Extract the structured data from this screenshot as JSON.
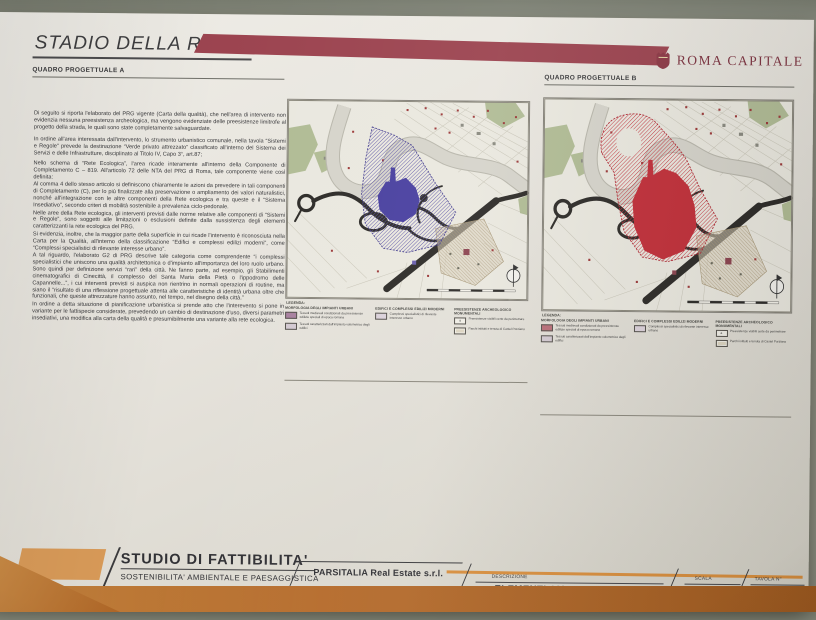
{
  "page": {
    "wall_color": "#8d9184",
    "table_color": "#b56b2b",
    "paper_color": "#e7e4dd",
    "accent_band_red": "#9c4450",
    "accent_orange": "#d89a58",
    "overlay_purple": "#4a41a0",
    "overlay_red": "#c2303a"
  },
  "header": {
    "title": "STADIO DELLA ROMA",
    "brand": "ROMA CAPITALE",
    "panel_a_label": "QUADRO PROGETTUALE A",
    "panel_b_label": "QUADRO PROGETTUALE B"
  },
  "intro": {
    "paragraphs": [
      "Di seguito si riporta l'elaborato del PRG vigente (Carta della qualità), che nell'area di intervento non evidenzia nessuna preesistenza archeologica, ma vengono evidenziate delle preesistenze limitrofe al progetto della strada, le quali sono state completamente salvaguardate.",
      "In ordine all'area interessata dall'intervento, lo strumento urbanistico comunale, nella tavola “Sistemi e Regole” prevede la destinazione “Verde privato attrezzato” classificato all'interno del Sistema dei Servizi e delle Infrastrutture, disciplinato al Titolo IV, Capo 3°, art.87;",
      "Nello schema di “Rete Ecologica”, l'area ricade interamente all'interno della Componente di Completamento C – 819. All'articolo 72 delle NTA del PRG di Roma, tale componente viene così definita:",
      "Al comma 4 dello stesso articolo si definiscono chiaramente le azioni da prevedere in tali componenti di Completamento (C), per lo più finalizzate alla preservazione o ampliamento dei valori naturalistici, nonché all'integrazione con le altre componenti della Rete ecologica e tra queste e il “Sistema Insediativo”, secondo criteri di mobilità sostenibile a prevalenza ciclo-pedonale.",
      "Nelle aree della Rete ecologica, gli interventi previsti dalle norme relative alle componenti di “Sistemi e Regole”, sono soggetti alle limitazioni o esclusioni definite dalla sussistenza degli elementi caratterizzanti la rete ecologica del PRG.",
      "Si evidenzia, inoltre, che la maggior parte della superficie in cui ricade l'intervento è riconosciuta nella Carta per la Qualità, all'interno della classificazione “Edifici e complessi edilizi moderni”, come “Complessi specialistici di rilevante interesse urbano”.",
      "A tal riguardo, l'elaborato G2 di PRG descrive tale categoria come comprendente “i complessi specialistici che uniscono una qualità architettonica o d'impianto all'importanza del loro ruolo urbano. Sono quindi per definizione servizi “rari” della città. Ne fanno parte, ad esempio, gli Stabilimenti cinematografici di Cinecittà, il complesso del Santa Maria della Pietà o l'ippodromo delle Capannelle...”, i cui interventi previsti si auspica non rientrino in normali operazioni di routine, ma siano il “risultato di una riflessione progettuale attenta alle caratteristiche di identità urbana oltre che funzionali, che queste attrezzature hanno assunto, nel tempo, nel disegno della città.”",
      "In ordine a detta situazione di pianificazione urbanistica si prende atto che l'interevento si pone in variante per le fattispecie considerate, prevedendo un cambio di destinazione d'uso, diversi parametri insediativi, una modifica alla carta della qualità e presumibilmente una variante alla rete ecologica."
    ]
  },
  "legend": {
    "title": "LEGENDA:",
    "columns": [
      {
        "header": "MORFOLOGIA DEGLI IMPIANTI URBANI",
        "items": [
          {
            "label": "Tessuti medievali condizionati da preesistenze edilizie speciali di epoca romana"
          },
          {
            "label": "Tessuti caratterizzati dall'impianto volumetrico degli edifici"
          }
        ]
      },
      {
        "header": "EDIFICI E COMPLESSI EDILIZI MODERNI",
        "items": [
          {
            "label": "Complessi specialistici di rilevante interesse urbano"
          }
        ]
      },
      {
        "header": "PREESISTENZE ARCHEOLOGICO MONUMENTALI",
        "items": [
          {
            "swatch_letter": "a",
            "label": "Preesistenze visibili certe da perimetrare"
          },
          {
            "label": "Parchi istituiti e tenuta di Castel Porziano"
          }
        ]
      }
    ]
  },
  "titleblock": {
    "title": "STUDIO DI FATTIBILITA'",
    "subtitle": "SOSTENIBILITA' AMBIENTALE  E PAESAGGISTICA",
    "company": "PARSITALIA Real Estate s.r.l.",
    "description_label": "DESCRIZIONE",
    "description": "ELEMENTI AMBIENTALI",
    "scale_label": "SCALA",
    "scale_value": "·",
    "sheet_label": "TAVOLA N°",
    "sheet_number": "N-32"
  }
}
